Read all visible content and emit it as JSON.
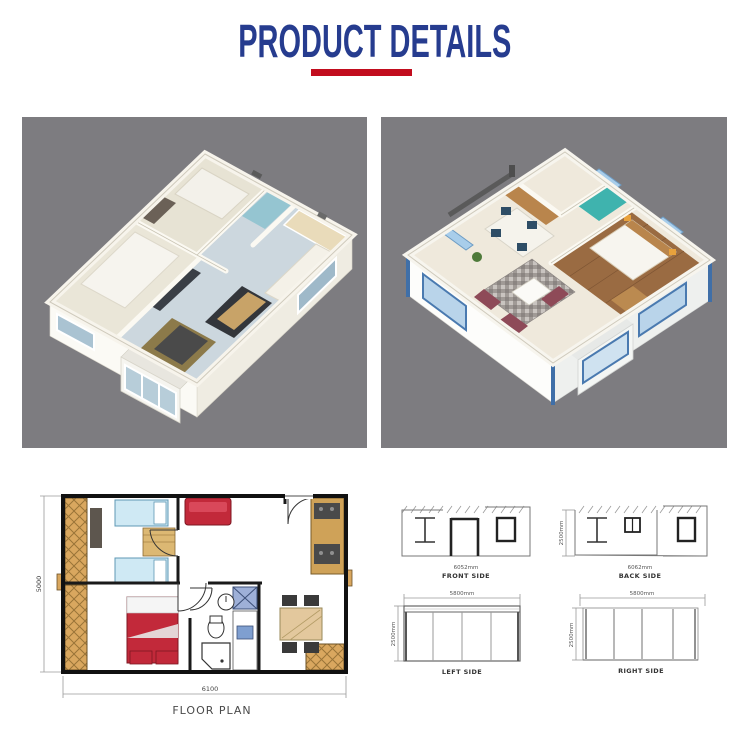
{
  "title": {
    "text": "PRODUCT DETAILS"
  },
  "images": {
    "left_alt": "3d-isometric-floorplan-render-1",
    "right_alt": "3d-isometric-floorplan-render-2"
  },
  "floor_plan": {
    "label": "FLOOR PLAN",
    "width_dim": "6100",
    "depth_dim": "5000"
  },
  "elevations": {
    "front": {
      "label": "FRONT SIDE",
      "width": "6052mm"
    },
    "back": {
      "label": "BACK SIDE",
      "width": "6062mm",
      "height": "2500mm"
    },
    "left": {
      "label": "LEFT SIDE",
      "width": "5800mm",
      "height": "2500mm"
    },
    "right": {
      "label": "RIGHT SIDE",
      "width": "5800mm",
      "height": "2500mm"
    }
  },
  "colors": {
    "accent_red": "#c20d1e",
    "title_navy": "#263c8f",
    "panel_gray": "#7d7c80",
    "plan_red": "#c2293a",
    "plan_blue_bed": "#cfe9f4",
    "plan_wood": "#d9a75f"
  }
}
